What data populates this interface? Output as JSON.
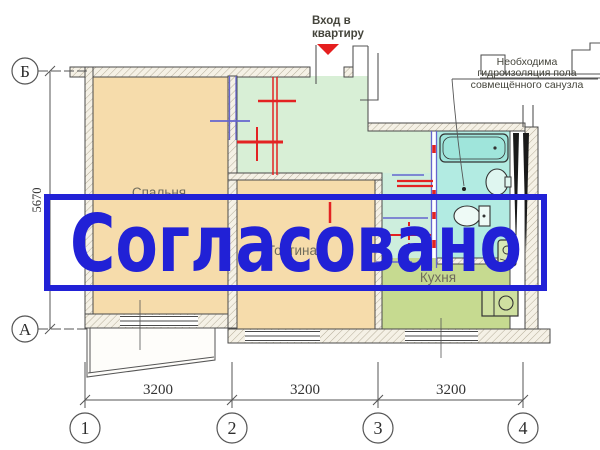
{
  "stamp": {
    "label": "Согласовано",
    "color": "#2121d6"
  },
  "plan": {
    "rooms": [
      {
        "id": "bedroom",
        "label": "Спальня"
      },
      {
        "id": "living",
        "label": "Гостиная"
      },
      {
        "id": "kitchen",
        "label": "Кухня"
      }
    ],
    "entrance_note": {
      "line1": "Вход в",
      "line2": "квартиру"
    },
    "waterproofing_note": {
      "line1": "Необходима",
      "line2": "гидроизоляция пола",
      "line3": "совмещённого санузла"
    }
  },
  "dimensions": {
    "vertical": "5670",
    "bottom": [
      "3200",
      "3200",
      "3200"
    ]
  },
  "axes": {
    "row_top": "Б",
    "row_bottom": "А",
    "cols": [
      "1",
      "2",
      "3",
      "4"
    ]
  },
  "colors": {
    "stamp_blue": "#2121d6",
    "bedroom_fill": "#f6dcab",
    "living_fill": "#f6dcab",
    "hall_fill": "#d8efd6",
    "bathroom_fill": "#b2ebe2",
    "kitchen_fill": "#c6da90",
    "marking_red": "#e32222",
    "marking_blue": "#6565cf",
    "entrance_arrow_red": "#e51f1f"
  }
}
